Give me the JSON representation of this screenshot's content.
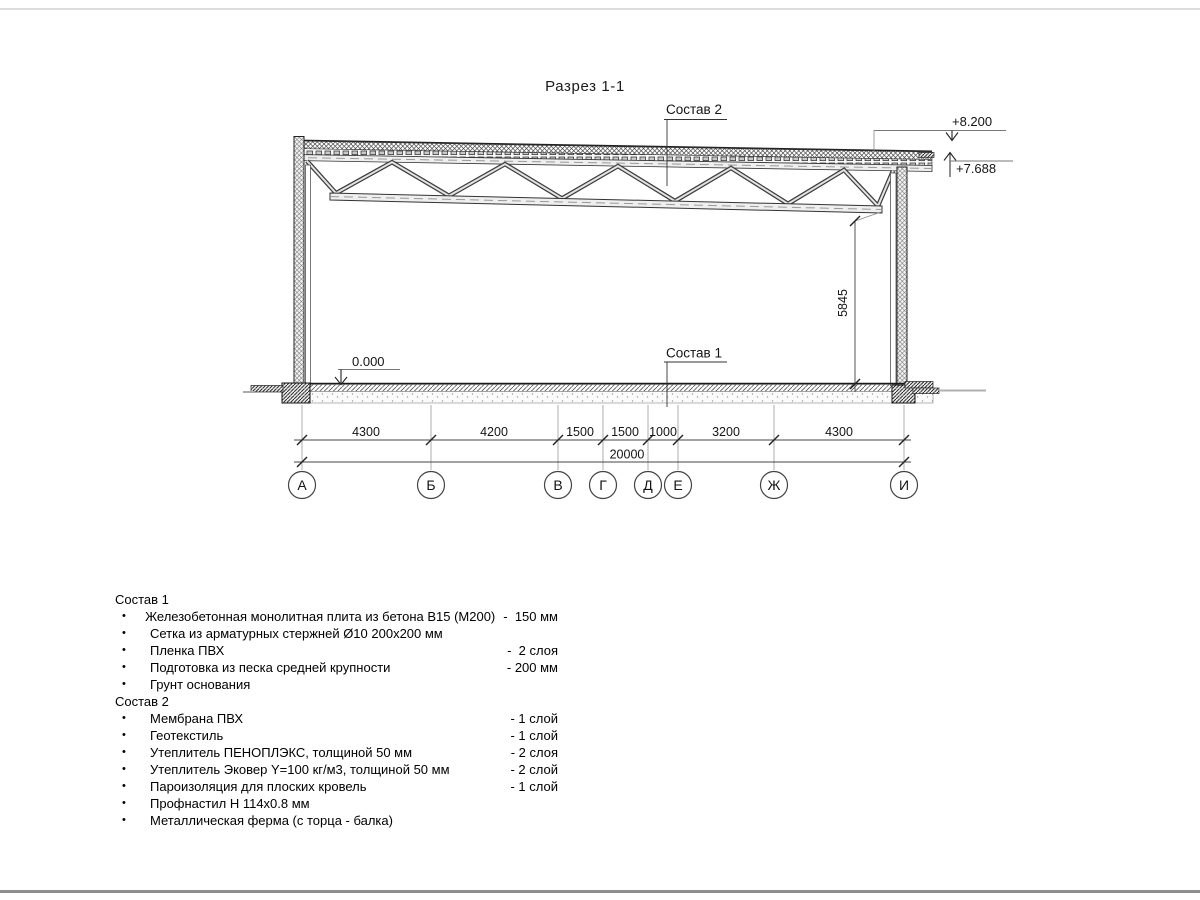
{
  "page": {
    "title": "Разрез 1-1"
  },
  "drawing": {
    "labels": {
      "composition2": "Состав 2",
      "composition1": "Состав 1",
      "level_roof_top": "+8.200",
      "level_eave": "+7.688",
      "level_floor": "0.000",
      "height_dim": "5845"
    },
    "dimensions": {
      "segments": [
        "4300",
        "4200",
        "1500",
        "1500",
        "1000",
        "3200",
        "4300"
      ],
      "total": "20000"
    },
    "axes": [
      "А",
      "Б",
      "В",
      "Г",
      "Д",
      "Е",
      "Ж",
      "И"
    ]
  },
  "legend": {
    "bullet": "•",
    "composition1": {
      "title": "Состав 1",
      "items": [
        {
          "name": "Железобетонная монолитная плита из бетона В15 (М200)",
          "value": "-  150 мм"
        },
        {
          "name": "Сетка из арматурных стержней Ø10 200x200 мм",
          "value": ""
        },
        {
          "name": "Пленка ПВХ",
          "value": "-  2 слоя"
        },
        {
          "name": "Подготовка из песка средней крупности",
          "value": "- 200 мм"
        },
        {
          "name": "Грунт основания",
          "value": ""
        }
      ]
    },
    "composition2": {
      "title": "Состав 2",
      "items": [
        {
          "name": "Мембрана ПВХ",
          "value": "- 1 слой"
        },
        {
          "name": "Геотекстиль",
          "value": "- 1 слой"
        },
        {
          "name": "Утеплитель ПЕНОПЛЭКС, толщиной 50 мм",
          "value": "- 2 слоя"
        },
        {
          "name": "Утеплитель Эковер Y=100 кг/м3, толщиной 50 мм",
          "value": "- 2 слой"
        },
        {
          "name": "Пароизоляция для плоских кровель",
          "value": "- 1 слой"
        },
        {
          "name": "Профнастил Н 114x0.8 мм",
          "value": ""
        },
        {
          "name": "Металлическая ферма (с торца - балка)",
          "value": ""
        }
      ]
    }
  }
}
